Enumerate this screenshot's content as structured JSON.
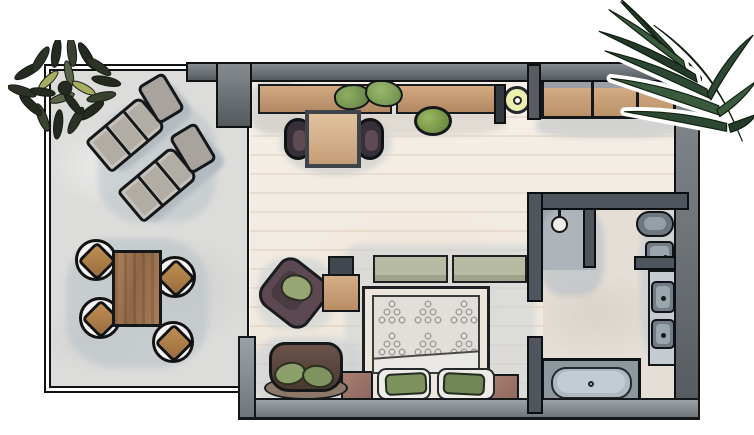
{
  "scene": {
    "title": "Hand-drawn top-view floor plan of a hotel suite with terrace, bedroom and bathroom",
    "style": "watercolor illustration, no text labels",
    "canvas": {
      "width": 754,
      "height": 435
    }
  },
  "palette": {
    "background": "#ffffff",
    "outline": "#15181a",
    "exterior_wall": "#6e7377",
    "bathroom_wall": "#4f565d",
    "bedroom_floor": "#f3ece3",
    "terrace_floor": "#dcdcda",
    "bathroom_floor": "#e4ded6",
    "wood": "#c49a76",
    "plant_green": "#6f8f53",
    "palm_green": "#2c4733",
    "cushion_green": "#7e9260",
    "sage_bench": "#b7bba2",
    "fixture_gray": "#8d979e",
    "sofa_brown": "#4f3c35",
    "armchair_plum": "#5c4850",
    "nightstand_rose": "#9b7468",
    "pendant_yellow": "#ecefae",
    "shadow_wash": "#c6ccd0"
  },
  "labels": {
    "plan": "Suite floor plan",
    "terrace": "Terrace",
    "bedroom": "Bedroom / living area",
    "entry": "Entry hall",
    "bathroom": "Bathroom",
    "corner_plant": "Corner plant",
    "palm": "Palm frond",
    "sun_lounger": "Sun lounger",
    "outdoor_table": "Outdoor dining table",
    "outdoor_chair": "Outdoor chair",
    "wall_shelf": "Wall shelf",
    "shelf_plant": "Potted plant on shelf",
    "floor_plant": "Potted floor plant",
    "desk": "Desk",
    "desk_chair": "Desk chair",
    "pendant_light": "Pendant light",
    "wardrobe": "Built-in wardrobe",
    "bed": "Double bed",
    "duvet": "Patterned duvet",
    "bench": "Foot-of-bed bench cushion",
    "pillow": "Pillow",
    "cushion": "Green accent cushion",
    "nightstand": "Nightstand",
    "armchair": "Armchair",
    "cabinet": "Minibar cabinet",
    "sofa": "Loveseat sofa",
    "shower": "Walk-in shower",
    "shower_head": "Shower head",
    "toilet": "Toilet",
    "wash_basin": "Wash basin",
    "vanity": "Vanity counter",
    "vanity_sink": "Vanity sink",
    "bathtub": "Bathtub",
    "wall": "Wall",
    "glass_wall": "Terrace window wall",
    "doorway": "Doorway"
  },
  "rooms": [
    {
      "name": "terrace",
      "items": [
        "corner plant",
        "2 sun loungers",
        "dining table",
        "4 chairs"
      ]
    },
    {
      "name": "bedroom",
      "items": [
        "wall shelf with 2 plants",
        "floor plant",
        "desk with 2 chairs",
        "wardrobe",
        "pendant light",
        "double bed",
        "foot bench",
        "2 pillows with green cushions",
        "2 nightstands",
        "armchair",
        "minibar cabinet",
        "loveseat sofa"
      ]
    },
    {
      "name": "bathroom",
      "items": [
        "walk-in shower",
        "toilet",
        "wash basin",
        "double vanity sinks",
        "bathtub"
      ]
    }
  ]
}
